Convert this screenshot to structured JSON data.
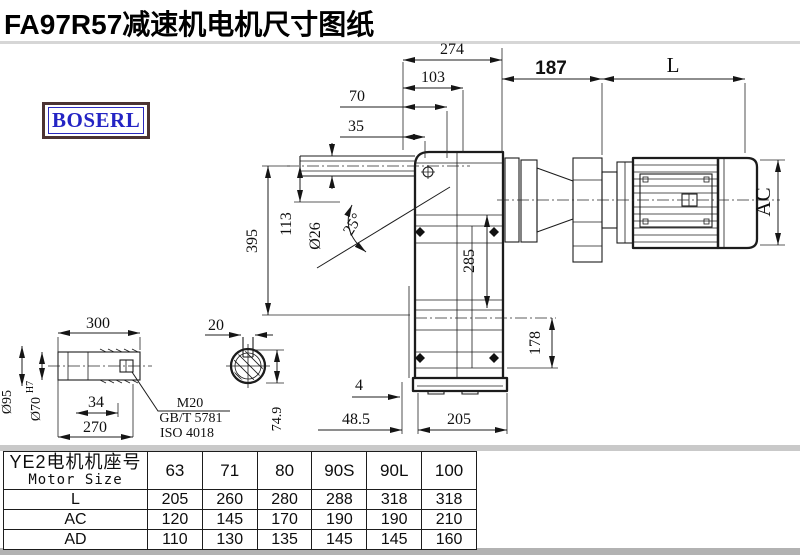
{
  "title": "FA97R57减速机电机尺寸图纸",
  "logo_text": "BOSERL",
  "colors": {
    "title": "#000000",
    "logo_text": "#2424c4",
    "logo_border": "#4b3333",
    "line": "#1c1c1c",
    "divider_band": "#c4c4c4"
  },
  "drawing_labels": [
    {
      "id": "274",
      "text": "274",
      "x": 452,
      "y": 54
    },
    {
      "id": "103",
      "text": "103",
      "x": 433,
      "y": 82
    },
    {
      "id": "70",
      "text": "70",
      "x": 357,
      "y": 101
    },
    {
      "id": "35",
      "text": "35",
      "x": 356,
      "y": 131
    },
    {
      "id": "187",
      "text": "187",
      "x": 551,
      "y": 74,
      "cls": "bold-sans"
    },
    {
      "id": "L",
      "text": "L",
      "x": 673,
      "y": 72,
      "cls": "lg"
    },
    {
      "id": "AC",
      "text": "AC",
      "x": 770,
      "y": 202,
      "rot": -90,
      "cls": "lg"
    },
    {
      "id": "395",
      "text": "395",
      "x": 257,
      "y": 241,
      "rot": -90
    },
    {
      "id": "113",
      "text": "113",
      "x": 291,
      "y": 224,
      "rot": -90
    },
    {
      "id": "dia26",
      "text": "Ø26",
      "x": 320,
      "y": 236,
      "rot": -90
    },
    {
      "id": "25deg",
      "text": "25°",
      "x": 357,
      "y": 227,
      "rot": -58
    },
    {
      "id": "285",
      "text": "285",
      "x": 474,
      "y": 261,
      "rot": -90
    },
    {
      "id": "178",
      "text": "178",
      "x": 540,
      "y": 343,
      "rot": -90
    },
    {
      "id": "4",
      "text": "4",
      "x": 359,
      "y": 390
    },
    {
      "id": "48.5",
      "text": "48.5",
      "x": 356,
      "y": 424
    },
    {
      "id": "205",
      "text": "205",
      "x": 459,
      "y": 424
    },
    {
      "id": "300",
      "text": "300",
      "x": 98,
      "y": 328
    },
    {
      "id": "dia95",
      "text": "Ø95",
      "x": 11,
      "y": 402,
      "rot": -90,
      "cls": "sm"
    },
    {
      "id": "dia70",
      "text": "Ø70",
      "x": 40,
      "y": 409,
      "rot": -90,
      "cls": "sm"
    },
    {
      "id": "H7",
      "text": "H7",
      "x": 33,
      "y": 387,
      "rot": -90,
      "cls": "xs"
    },
    {
      "id": "34",
      "text": "34",
      "x": 96,
      "y": 407
    },
    {
      "id": "270",
      "text": "270",
      "x": 95,
      "y": 432
    },
    {
      "id": "M20",
      "text": "M20",
      "x": 190,
      "y": 407,
      "cls": "sm"
    },
    {
      "id": "GBT5781",
      "text": "GB/T 5781",
      "x": 191,
      "y": 422,
      "cls": "sm"
    },
    {
      "id": "ISO4018",
      "text": "ISO 4018",
      "x": 187,
      "y": 437,
      "cls": "sm"
    },
    {
      "id": "20",
      "text": "20",
      "x": 216,
      "y": 330
    },
    {
      "id": "74.9",
      "text": "74.9",
      "x": 281,
      "y": 419,
      "rot": -90,
      "cls": "sm"
    }
  ],
  "table": {
    "header_cn": "YE2电机机座号",
    "header_en": "Motor Size",
    "sizes": [
      "63",
      "71",
      "80",
      "90S",
      "90L",
      "100"
    ],
    "rows": [
      {
        "label": "L",
        "values": [
          "205",
          "260",
          "280",
          "288",
          "318",
          "318"
        ]
      },
      {
        "label": "AC",
        "values": [
          "120",
          "145",
          "170",
          "190",
          "190",
          "210"
        ]
      },
      {
        "label": "AD",
        "values": [
          "110",
          "130",
          "135",
          "145",
          "145",
          "160"
        ]
      }
    ]
  }
}
